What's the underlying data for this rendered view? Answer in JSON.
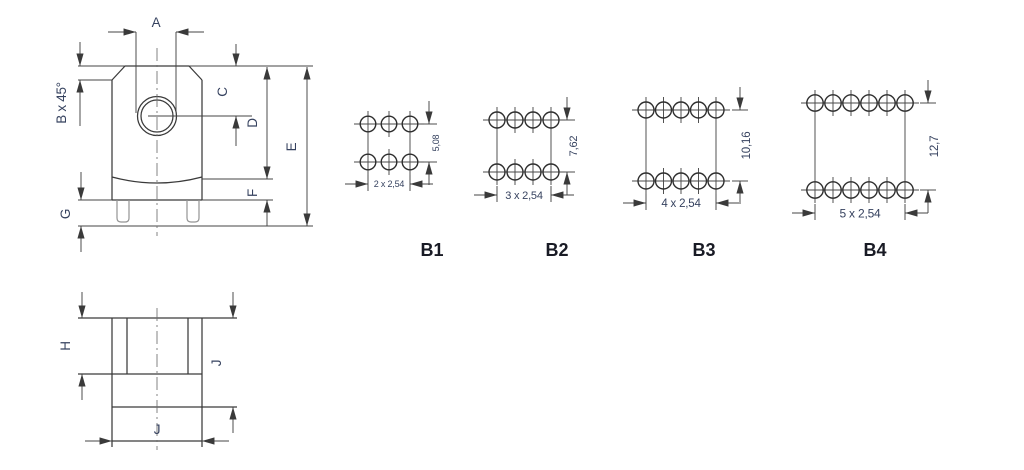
{
  "front_view": {
    "labels": {
      "a": "A",
      "chamfer": "B x 45°",
      "c": "C",
      "d": "D",
      "e": "E",
      "f": "F",
      "g": "G"
    }
  },
  "side_view": {
    "labels": {
      "h": "H",
      "height": "J",
      "width": "J"
    }
  },
  "footprints": [
    {
      "label": "B1",
      "pins_per_row": 3,
      "rows": 2,
      "row_spacing": "5,08",
      "pin_pitch": "2 x 2,54"
    },
    {
      "label": "B2",
      "pins_per_row": 4,
      "rows": 2,
      "row_spacing": "7,62",
      "pin_pitch": "3 x 2,54"
    },
    {
      "label": "B3",
      "pins_per_row": 5,
      "rows": 2,
      "row_spacing": "10,16",
      "pin_pitch": "4 x 2,54"
    },
    {
      "label": "B4",
      "pins_per_row": 6,
      "rows": 2,
      "row_spacing": "12,7",
      "pin_pitch": "5 x 2,54"
    }
  ],
  "colors": {
    "line": "#3a3a3a",
    "dim_text": "#36425f",
    "footprint_label": "#191b25",
    "pin_gray": "#949494",
    "background": "#ffffff"
  }
}
